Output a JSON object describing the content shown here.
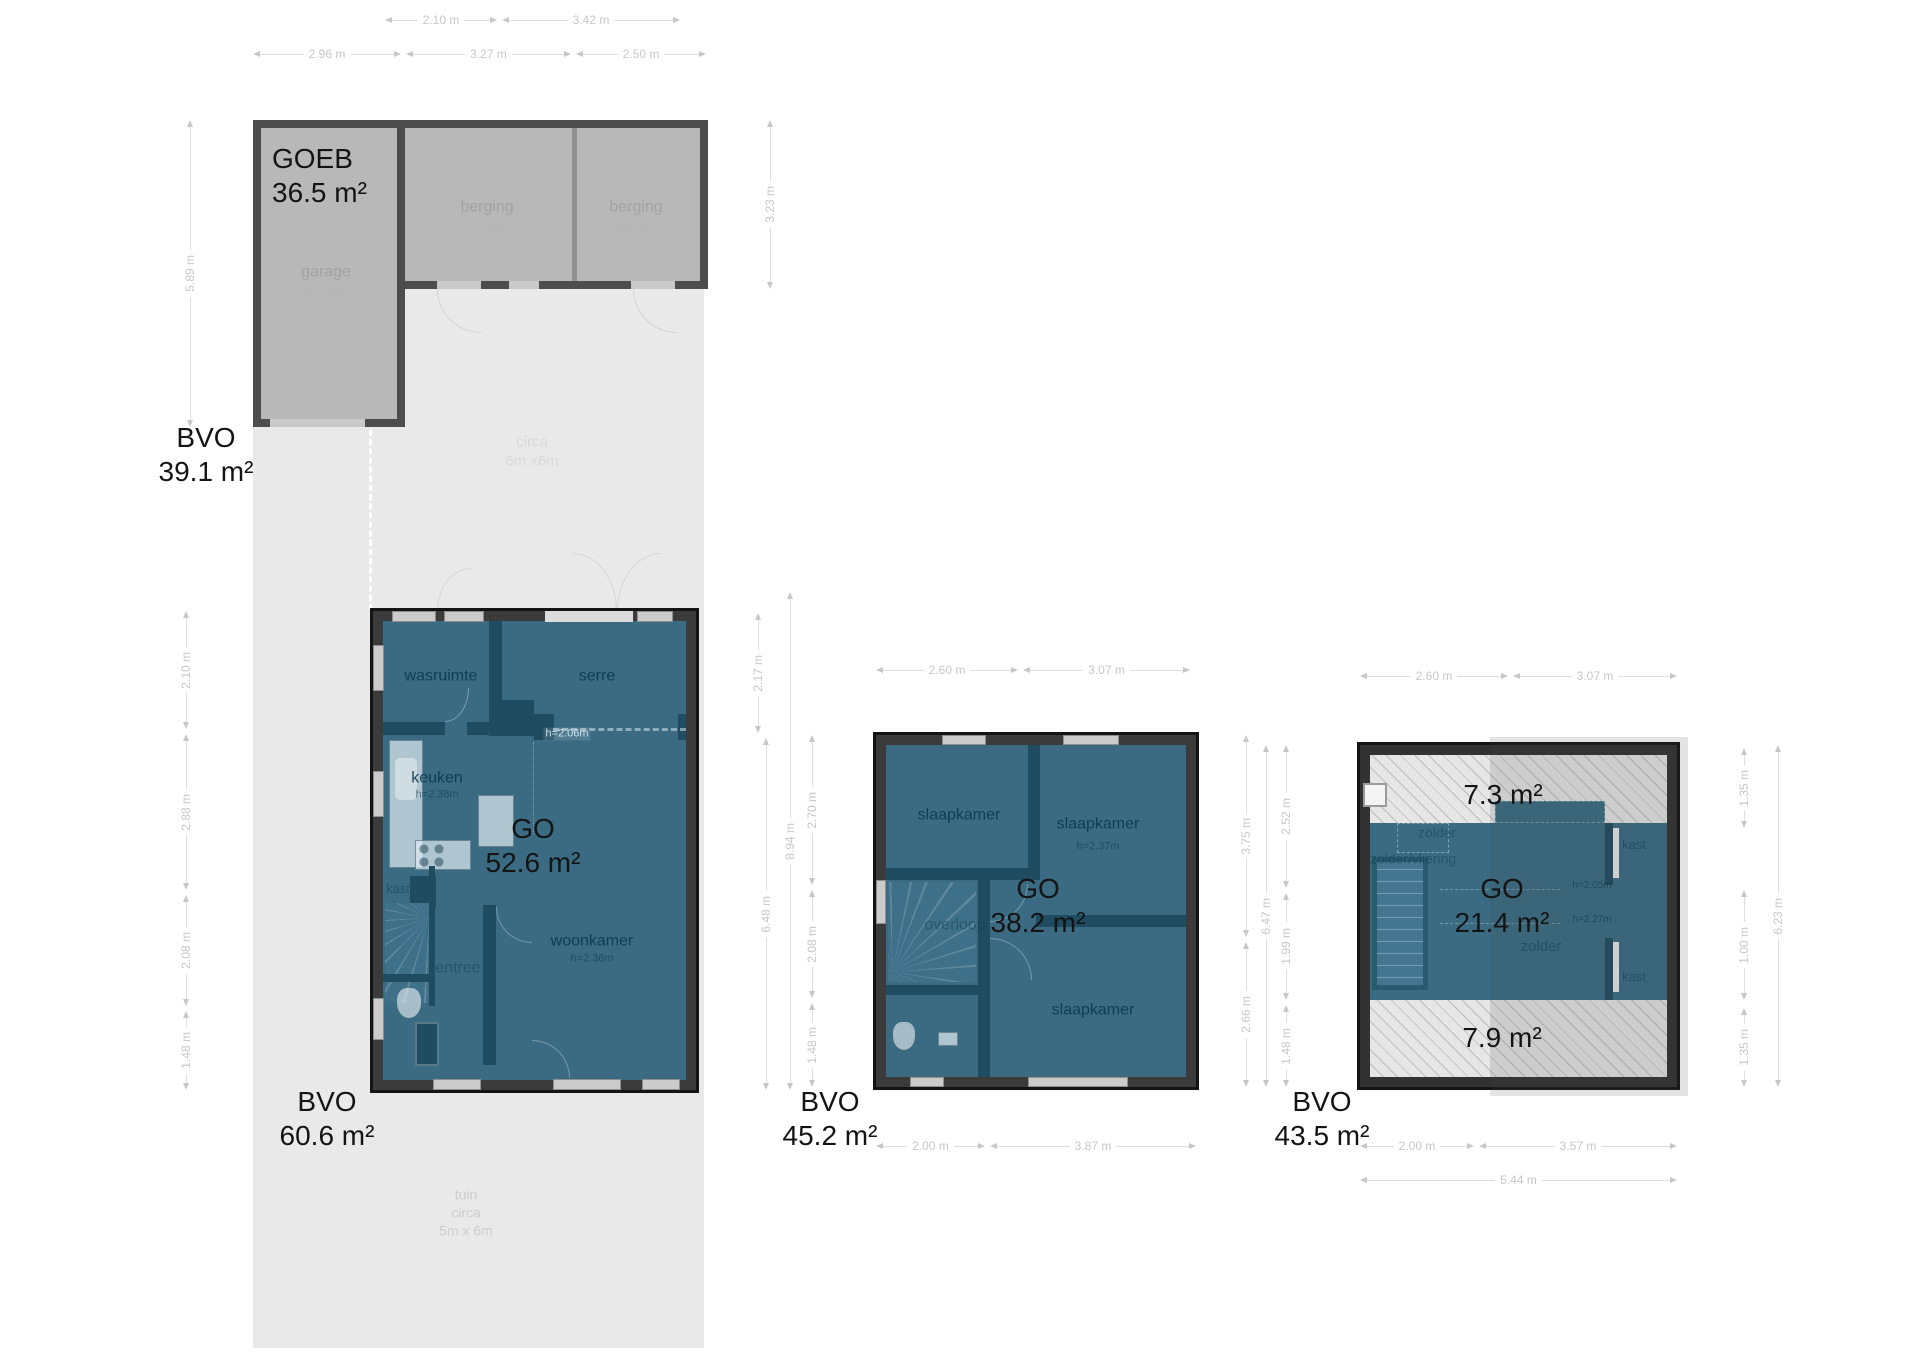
{
  "colors": {
    "floor_fill": "#3a6b83",
    "wall": "#3b3b3b",
    "outbuilding_fill": "#b8b8b8",
    "outbuilding_wall": "#4d4d4d",
    "terrain": "#e9e9e9",
    "dimension_text": "#c7c7c7"
  },
  "outbuilding": {
    "title": "GOEB",
    "area": "36.5 m²",
    "bvo": {
      "label": "BVO",
      "area": "39.1 m²"
    },
    "rooms": {
      "garage": {
        "name": "garage",
        "height": "h=2.39m"
      },
      "berging_left": {
        "name": "berging",
        "height": "h=2.23m"
      },
      "berging_right": {
        "name": "berging",
        "height": "h=2.23m"
      }
    },
    "dims": {
      "top_row1": [
        "2.10 m",
        "3.42 m"
      ],
      "top_row2": [
        "2.96 m",
        "3.27 m",
        "2.50 m"
      ],
      "left": "5.89 m",
      "right": "3.23 m"
    }
  },
  "site": {
    "clearing_note": [
      "circa",
      "6m x6m"
    ],
    "garden_note": [
      "tuin",
      "circa",
      "5m x 6m"
    ]
  },
  "ground_floor": {
    "go": {
      "label": "GO",
      "area": "52.6 m²"
    },
    "bvo": {
      "label": "BVO",
      "area": "60.6 m²"
    },
    "rooms": {
      "wasruimte": {
        "name": "wasruimte"
      },
      "serre": {
        "name": "serre"
      },
      "keuken": {
        "name": "keuken",
        "height": "h=2.38m"
      },
      "woonkamer": {
        "name": "woonkamer",
        "height": "h=2.36m"
      },
      "entree": {
        "name": "entree"
      },
      "kast": {
        "name": "kast"
      }
    },
    "opening_height": "h=2.06m",
    "dims": {
      "left": [
        "2.10 m",
        "2.88 m",
        "2.08 m",
        "1.48 m"
      ],
      "right_inner": [
        "2.17 m",
        "6.48 m"
      ],
      "right_outer": "8.94 m"
    }
  },
  "first_floor": {
    "go": {
      "label": "GO",
      "area": "38.2 m²"
    },
    "bvo": {
      "label": "BVO",
      "area": "45.2 m²"
    },
    "rooms": {
      "slaapkamer_1": {
        "name": "slaapkamer"
      },
      "slaapkamer_2": {
        "name": "slaapkamer",
        "height": "h=2.37m"
      },
      "slaapkamer_3": {
        "name": "slaapkamer"
      },
      "overloop": {
        "name": "overloop"
      }
    },
    "dims": {
      "top": [
        "2.60 m",
        "3.07 m"
      ],
      "bottom": [
        "2.00 m",
        "3.87 m"
      ],
      "left": [
        "2.70 m",
        "2.08 m",
        "1.48 m"
      ],
      "right": [
        "3.75 m",
        "2.66 m"
      ]
    }
  },
  "attic": {
    "go": {
      "label": "GO",
      "area": "21.4 m²"
    },
    "bvo": {
      "label": "BVO",
      "area": "43.5 m²"
    },
    "zones": {
      "top_area": "7.3 m²",
      "bottom_area": "7.9 m²"
    },
    "rooms": {
      "zolder_left": {
        "name": "zolder"
      },
      "vliering": {
        "name": "zolder/vliering"
      },
      "zolder_main": {
        "name": "zolder"
      },
      "kast_top": {
        "name": "kast"
      },
      "kast_bottom": {
        "name": "kast"
      }
    },
    "heights": [
      "h=2.05m",
      "h=2.27m"
    ],
    "dims": {
      "top": [
        "2.60 m",
        "3.07 m"
      ],
      "bottom": [
        "2.00 m",
        "3.57 m"
      ],
      "bottom_overall": "5.44 m",
      "left": [
        "2.52 m",
        "1.99 m",
        "1.48 m"
      ],
      "left_overall": "6.47 m",
      "right": [
        "1.35 m",
        "1.00 m",
        "1.35 m"
      ],
      "right_overall": "6.23 m"
    }
  }
}
